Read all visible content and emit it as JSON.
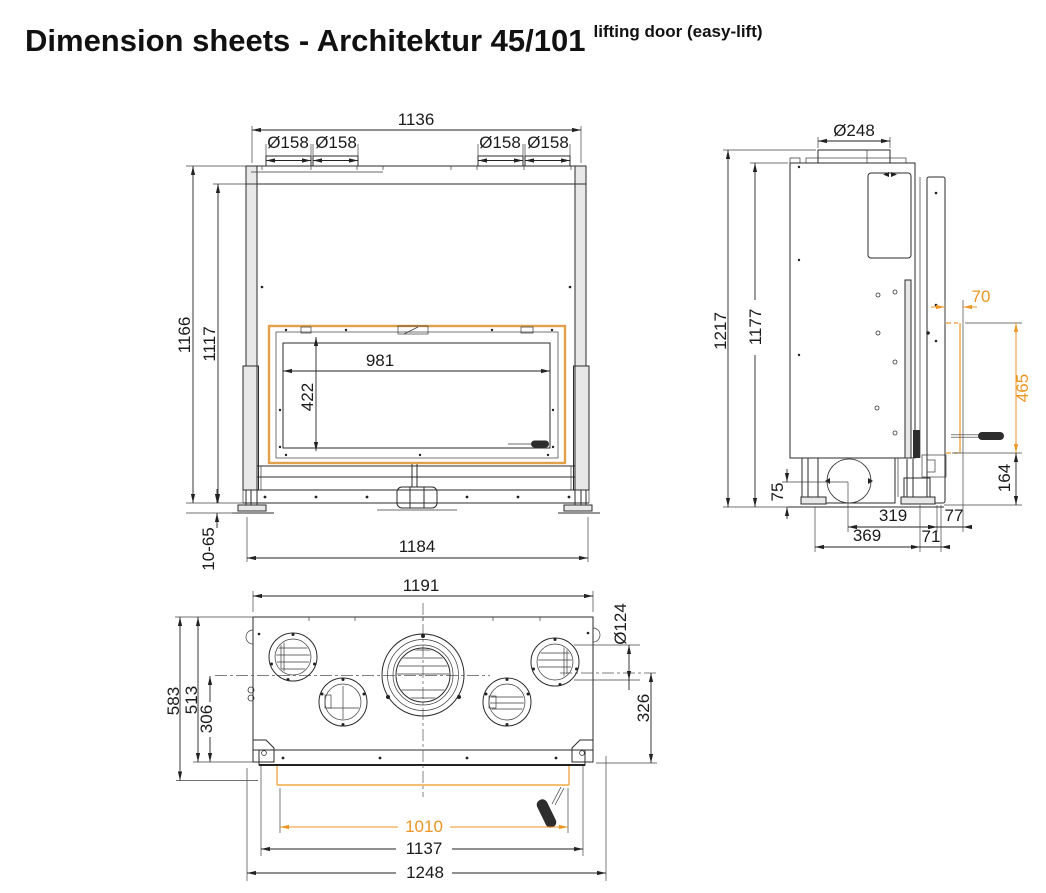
{
  "title": {
    "main": "Dimension sheets - Architektur 45/101",
    "superscript": "lifting door (easy-lift)"
  },
  "colors": {
    "line": "#2b2b2b",
    "accent_orange": "#EC9625",
    "door_frame_orange": "#E2A04A"
  },
  "views": {
    "front": {
      "label": "front-view",
      "dims": {
        "top_width": "1136",
        "collars": [
          "Ø158",
          "Ø158",
          "Ø158",
          "Ø158"
        ],
        "height_total": "1166",
        "height_body": "1117",
        "glass_width": "981",
        "glass_height": "422",
        "leg_adjust": "10-65",
        "base_width": "1184"
      }
    },
    "side": {
      "label": "side-view",
      "dims": {
        "flue_diameter": "Ø248",
        "height_total": "1217",
        "height_body": "1177",
        "frame_offset": "70",
        "glass_height": "465",
        "handle_height": "164",
        "plinth_height": "75",
        "air_center_to_front": "319",
        "front_offset": "77",
        "feet_spacing": "369",
        "foot_to_front": "71"
      }
    },
    "plan": {
      "label": "plan-view",
      "dims": {
        "top_width": "1191",
        "outlet_diameter": "Ø124",
        "depth_total": "583",
        "depth_body": "513",
        "depth_flue_center": "306",
        "flue_center_to_front": "326",
        "opening_width": "1010",
        "frame_width": "1137",
        "total_width": "1248"
      }
    }
  }
}
